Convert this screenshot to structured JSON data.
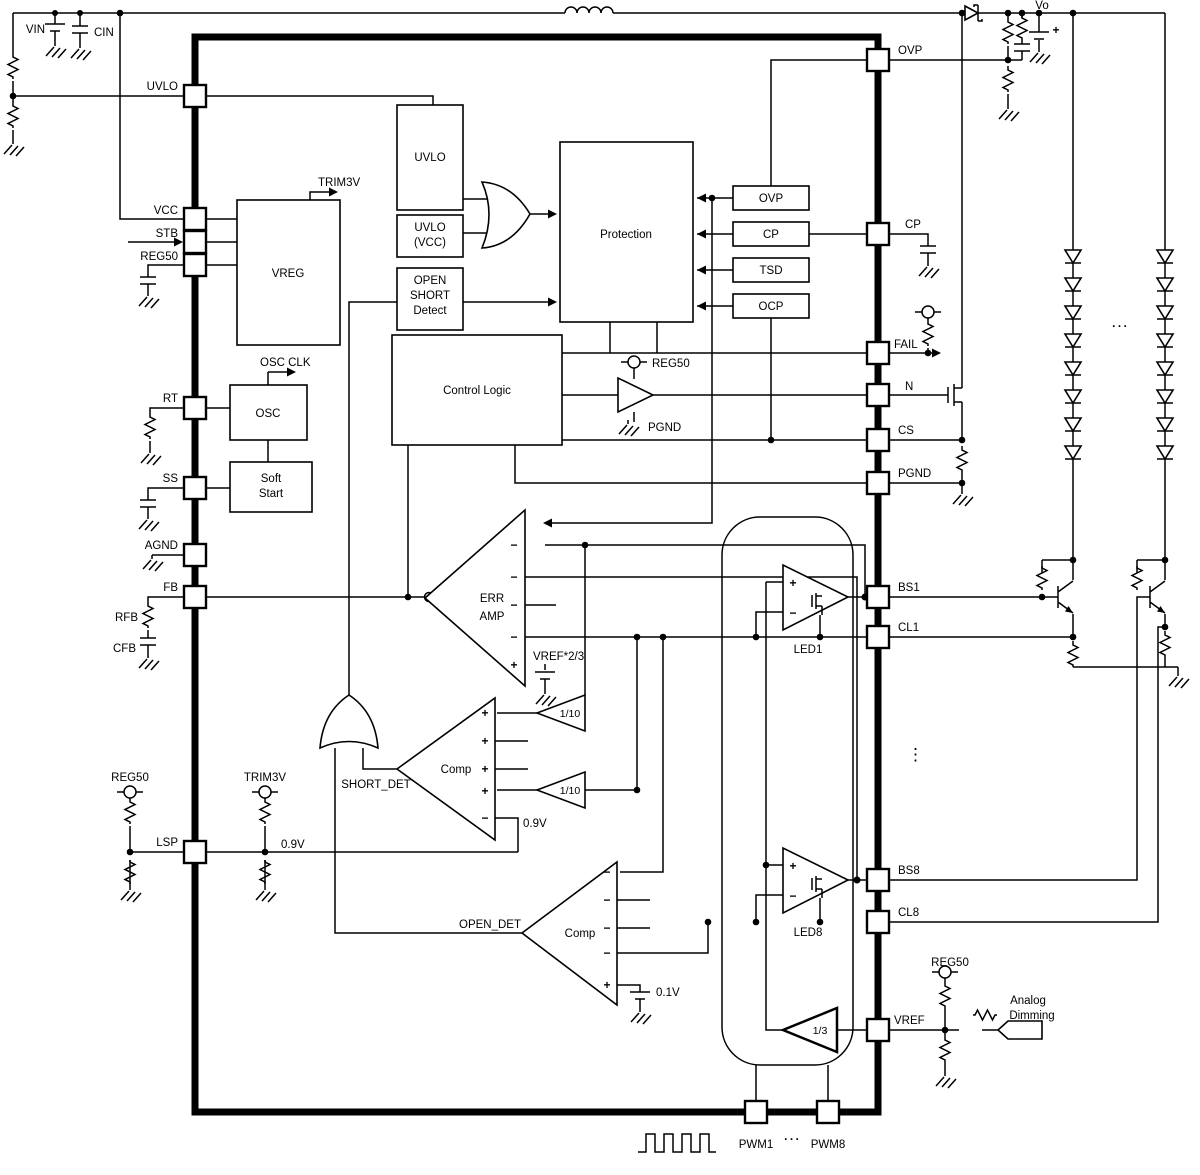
{
  "pins": {
    "left": [
      "UVLO",
      "VCC",
      "STB",
      "REG50",
      "RT",
      "SS",
      "AGND",
      "FB",
      "LSP"
    ],
    "right": [
      "OVP",
      "CP",
      "FAIL",
      "N",
      "CS",
      "PGND",
      "BS1",
      "CL1",
      "BS8",
      "CL8",
      "VREF"
    ],
    "bottom": [
      "PWM1",
      "PWM8"
    ]
  },
  "blocks": {
    "vreg": "VREG",
    "uvlo": "UVLO",
    "uvlo_vcc": [
      "UVLO",
      "(VCC)"
    ],
    "open_short_detect": [
      "OPEN",
      "SHORT",
      "Detect"
    ],
    "protection": "Protection",
    "fault_inputs": [
      "OVP",
      "CP",
      "TSD",
      "OCP"
    ],
    "control_logic": "Control Logic",
    "osc": "OSC",
    "soft_start": [
      "Soft",
      "Start"
    ],
    "err_amp": [
      "ERR",
      "AMP"
    ],
    "comp": "Comp",
    "led1": "LED1",
    "led8": "LED8",
    "div_1_10": "1/10",
    "div_1_3": "1/3"
  },
  "labels": {
    "vin": "VIN",
    "cin": "CIN",
    "vo": "Vo",
    "trim3v": "TRIM3V",
    "osc_clk": "OSC CLK",
    "reg50": "REG50",
    "pgnd": "PGND",
    "vref_2_3": "VREF*2/3",
    "v0_9": "0.9V",
    "v0_1": "0.1V",
    "short_det": "SHORT_DET",
    "open_det": "OPEN_DET",
    "rfb": "RFB",
    "cfb": "CFB",
    "analog": "Analog",
    "dimming": "Dimming",
    "hdots": "...",
    "vdots": "⋮"
  },
  "signs": {
    "plus": "+",
    "minus": "−"
  },
  "colors": {
    "line": "#000000",
    "background": "#ffffff"
  }
}
